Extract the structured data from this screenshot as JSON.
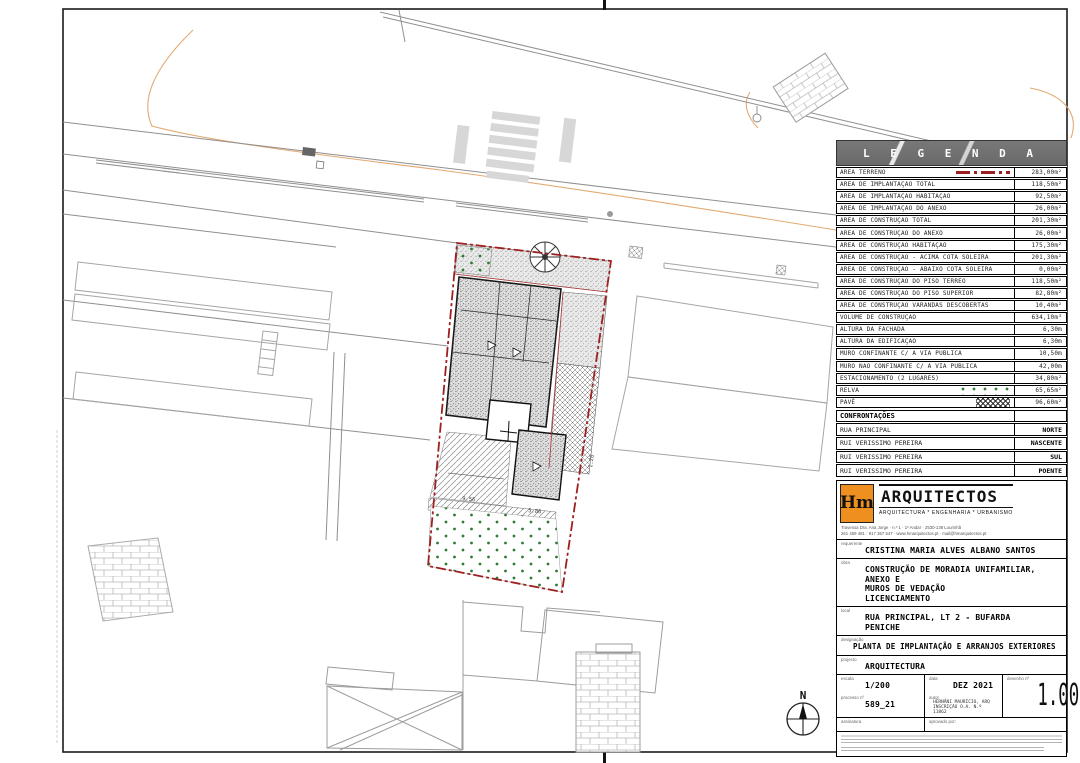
{
  "colors": {
    "accent_red": "#9e1f1f",
    "grass_green": "#2e7d32",
    "logo_orange": "#ef8f1f"
  },
  "legend": {
    "title": "L E G E N D A",
    "rows": [
      {
        "label": "ÁREA TERRENO",
        "value": "283,00m²",
        "sample": "sw-terrain"
      },
      {
        "label": "ÁREA DE IMPLANTAÇÃO TOTAL",
        "value": "118,50m²"
      },
      {
        "label": "ÁREA DE IMPLANTAÇÃO HABITAÇÃO",
        "value": "92,50m²"
      },
      {
        "label": "ÁREA DE IMPLANTAÇÃO DO ANEXO",
        "value": "26,00m²"
      },
      {
        "label": "ÁREA DE CONSTRUÇÃO TOTAL",
        "value": "201,30m²"
      },
      {
        "label": "ÁREA DE CONSTRUÇÃO DO ANEXO",
        "value": "26,00m²"
      },
      {
        "label": "ÁREA DE CONSTRUÇÃO HABITAÇÃO",
        "value": "175,30m²"
      },
      {
        "label": "ÁREA DE CONSTRUÇÃO - ACIMA COTA SOLEIRA",
        "value": "201,30m²"
      },
      {
        "label": "ÁREA DE CONSTRUÇÃO - ABAIXO COTA SOLEIRA",
        "value": "0,00m²"
      },
      {
        "label": "ÁREA DE CONSTRUÇÃO DO PISO TÉRREO",
        "value": "118,50m²"
      },
      {
        "label": "ÁREA DE CONSTRUÇÃO DO PISO SUPERIOR",
        "value": "82,80m²"
      },
      {
        "label": "ÁREA DE CONSTRUÇÃO VARANDAS DESCOBERTAS",
        "value": "10,40m²"
      },
      {
        "label": "VOLUME DE CONSTRUÇÃO",
        "value": "634,10m³"
      },
      {
        "label": "ALTURA DA FACHADA",
        "value": "6,30m"
      },
      {
        "label": "ALTURA DA EDIFICAÇÃO",
        "value": "6,30m"
      },
      {
        "label": "MURO CONFINANTE C/ A VIA PÚBLICA",
        "value": "10,50m"
      },
      {
        "label": "MURO NÃO CONFINANTE C/ A VIA PÚBLICA",
        "value": "42,00m"
      },
      {
        "label": "ESTACIONAMENTO (2 LUGARES)",
        "value": "34,80m²"
      },
      {
        "label": "RELVA",
        "value": "65,65m²",
        "sample": "sw-grass"
      },
      {
        "label": "PAVÊ",
        "value": "96,60m²",
        "sample": "sw-pave"
      }
    ]
  },
  "confrontacoes": {
    "title": "CONFRONTAÇÕES",
    "rows": [
      {
        "label": "RUA PRINCIPAL",
        "side": "NORTE"
      },
      {
        "label": "RUI VERISSIMO PEREIRA",
        "side": "NASCENTE"
      },
      {
        "label": "RUI VERISSIMO PEREIRA",
        "side": "SUL"
      },
      {
        "label": "RUI VERISSIMO PEREIRA",
        "side": "POENTE"
      }
    ]
  },
  "firm": {
    "logo": "Hm",
    "name": "ARQUITECTOS",
    "tagline": "ARQUITECTURA * ENGENHARIA * URBANISMO",
    "address_line1": "Travessa Dra. Ana Jorge · n.º 1 · 1º Andar · 2530-138 Lourinhã",
    "address_line2": "261 459 481 · 917 367 547 · www.hmarquitectos.pt · mail@hmarquitectos.pt"
  },
  "fields": {
    "requerente_label": "requerente",
    "requerente": "CRISTINA MARIA ALVES ALBANO SANTOS",
    "obra_label": "obra",
    "obra_line1": "CONSTRUÇÃO DE MORADIA UNIFAMILIAR, ANEXO E",
    "obra_line2": "MUROS DE VEDAÇÃO",
    "obra_line3": "LICENCIAMENTO",
    "local_label": "local",
    "local_line1": "RUA PRINCIPAL, LT 2 - BUFARDA",
    "local_line2": "PENICHE",
    "designacao_label": "designação",
    "designacao": "PLANTA DE IMPLANTAÇÃO E ARRANJOS EXTERIORES",
    "projecto_label": "projecto",
    "projecto": "ARQUITECTURA",
    "escala_label": "escala",
    "escala": "1/200",
    "data_label": "data",
    "data": "DEZ 2021",
    "desenho_label": "desenho nº",
    "desenho_num": "1.00",
    "processo_label": "processo nº",
    "processo": "589_21",
    "autor_label": "autor",
    "autor_line1": "HERNÂNI MAURÍCIO, ARQ",
    "autor_line2": "INSCRIÇÃO O.A. N.º 11862",
    "assinatura_label": "assinatura",
    "aprovado_label": "aprovado por:"
  },
  "plan": {
    "compass_label": "N",
    "dim1": "9.56",
    "dim2": "5.86",
    "dim3": "1.26"
  }
}
